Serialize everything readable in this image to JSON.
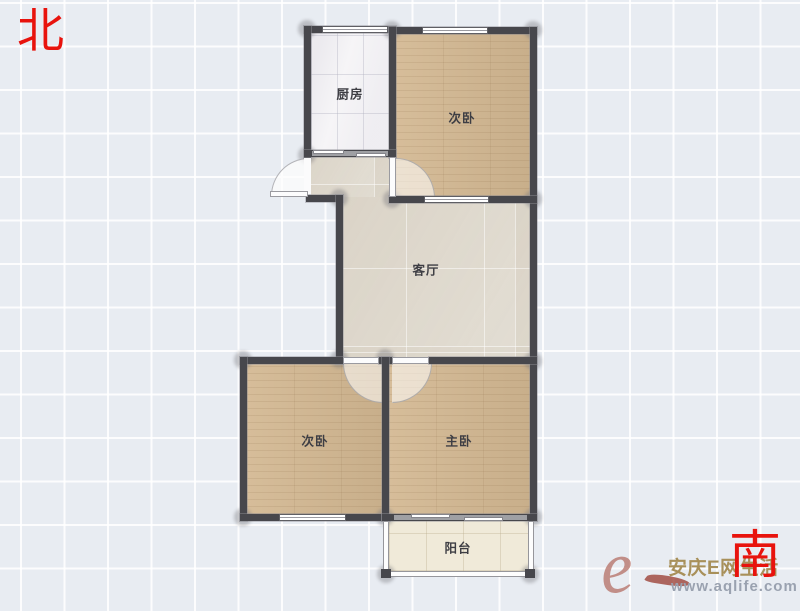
{
  "compass": {
    "north": "北",
    "south": "南"
  },
  "rooms": {
    "kitchen": {
      "label": "厨房"
    },
    "bedroom_north": {
      "label": "次卧"
    },
    "living": {
      "label": "客厅"
    },
    "bedroom_southwest": {
      "label": "次卧"
    },
    "bedroom_master": {
      "label": "主卧"
    },
    "balcony": {
      "label": "阳台"
    }
  },
  "watermark": {
    "logo_letter": "e",
    "site_name": "安庆E网生活",
    "site_url": "www.aqlife.com"
  },
  "colors": {
    "wall": "#47474c",
    "wood_floor": "#d3b892",
    "living_floor": "#ddd7cb",
    "kitchen_floor": "#f6f5f7",
    "balcony_floor": "#f0ead9",
    "compass_red": "#e8130d",
    "watermark_gold": "#a8905a",
    "watermark_gray": "#9aa2b0",
    "background": "#e8ecf2"
  }
}
